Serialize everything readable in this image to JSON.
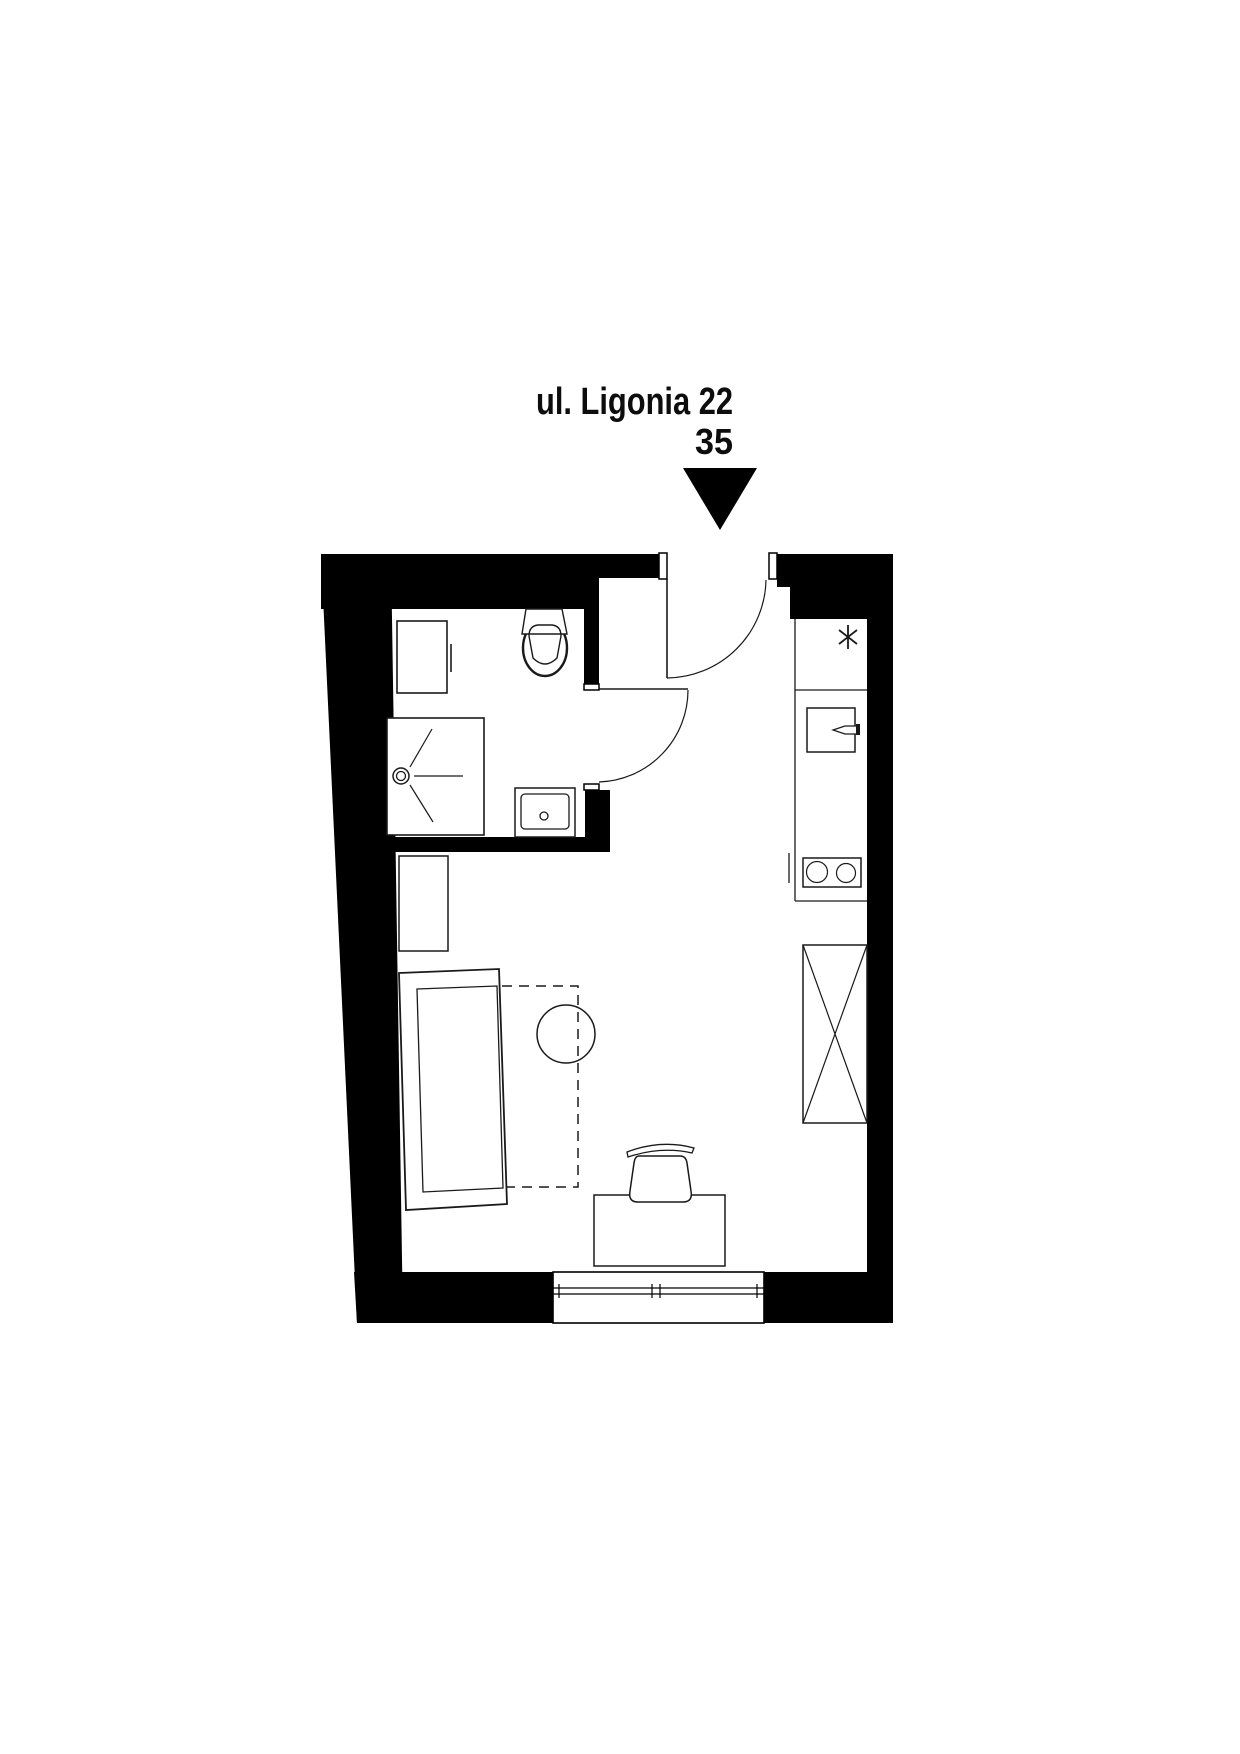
{
  "header": {
    "address": "ul. Ligonia 22",
    "unit": "35"
  },
  "colors": {
    "ink": "#000000",
    "paper": "#ffffff"
  },
  "plan": {
    "type": "apartment-floor-plan",
    "rooms": [
      "bathroom",
      "kitchen",
      "living-room",
      "entry"
    ],
    "symbols": [
      "entrance-arrow",
      "entry-door",
      "bathroom-door",
      "window",
      "washing-machine",
      "toilet",
      "shower",
      "washbasin",
      "kitchen-sink-point",
      "oven-cabinet",
      "cooktop",
      "wardrobe",
      "shelf",
      "bed",
      "rug-outline",
      "round-table",
      "desk",
      "desk-chair"
    ]
  }
}
